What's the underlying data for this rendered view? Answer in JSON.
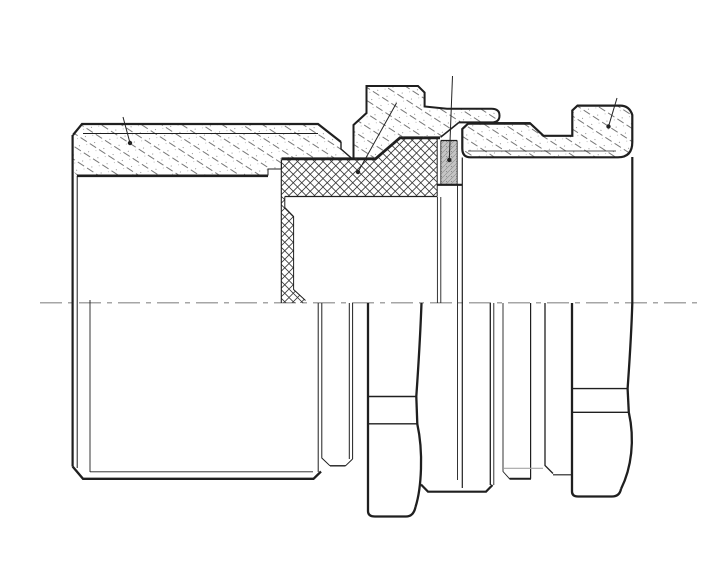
{
  "drawing": {
    "background": "#ffffff",
    "outline_color": "#1f1f1f",
    "hatch_color": "#4a4a4a",
    "crosshatch_color": "#3a3a3a",
    "seal_fill": "#c4c4c4",
    "centerline_color": "#a6a6a6",
    "leader_color": "#222222"
  }
}
